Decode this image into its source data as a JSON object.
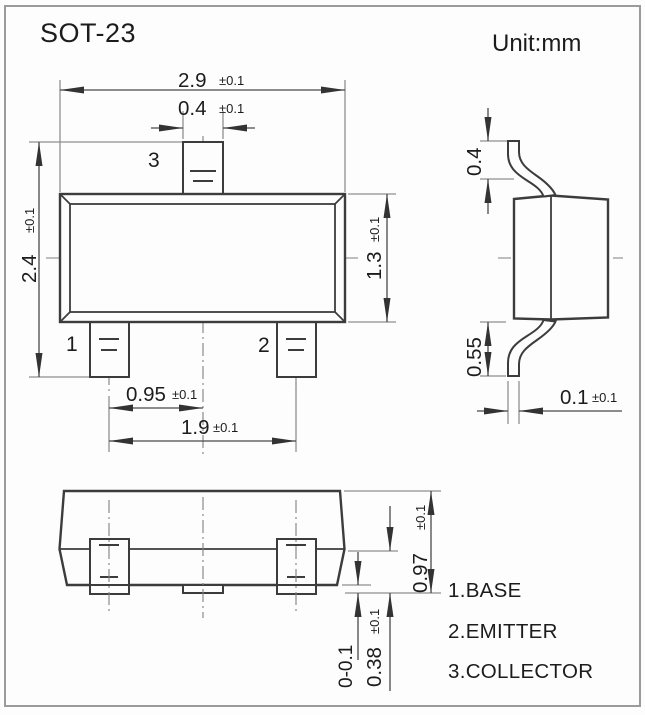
{
  "title": "SOT-23",
  "unit_label": "Unit:mm",
  "pin_numbers": {
    "p1": "1",
    "p2": "2",
    "p3": "3"
  },
  "legend": [
    "1.BASE",
    "2.EMITTER",
    "3.COLLECTOR"
  ],
  "dims": {
    "body_width": {
      "v": "2.9",
      "t": "±0.1"
    },
    "pin_width": {
      "v": "0.4",
      "t": "±0.1"
    },
    "overall_height": {
      "v": "2.4",
      "t": "±0.1"
    },
    "body_height": {
      "v": "1.3",
      "t": "±0.1"
    },
    "pin_pitch": {
      "v": "0.95",
      "t": "±0.1"
    },
    "pin_span": {
      "v": "1.9",
      "t": "±0.1"
    },
    "lead_top_length": {
      "v": "0.4",
      "t": ""
    },
    "lead_bottom_length": {
      "v": "0.55",
      "t": ""
    },
    "lead_thickness": {
      "v": "0.1",
      "t": "±0.1"
    },
    "front_height": {
      "v": "0.97",
      "t": "±0.1"
    },
    "standoff": {
      "v": "0-0.1",
      "t": ""
    },
    "lead_front_height": {
      "v": "0.38",
      "t": "±0.1"
    }
  },
  "colors": {
    "background": "#fdfdfd",
    "outline": "#3c3c3c",
    "dimension_line": "#4a4a4a",
    "extension_line": "#8f8f8f",
    "centerline": "#808080",
    "text": "#1c1c1c",
    "frame": "#9b9b9b"
  }
}
